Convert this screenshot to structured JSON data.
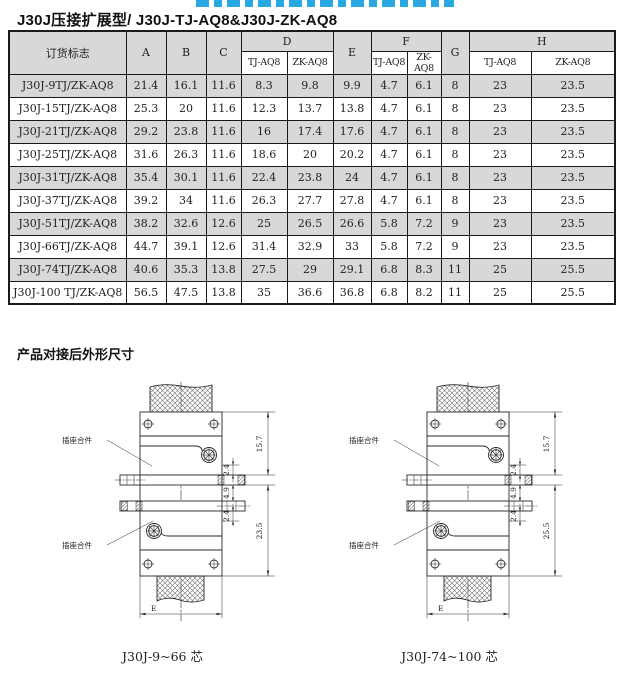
{
  "banner": {
    "note": "clipped blue heading, only glyph bottoms visible"
  },
  "title": "J30J压接扩展型/ J30J-TJ-AQ8&J30J-ZK-AQ8",
  "colors": {
    "banner_blue": "#29a9e2",
    "row_shade": "#d8d8d8",
    "line": "#2a2a2a"
  },
  "table": {
    "header": {
      "order_mark": "订货标志",
      "a": "A",
      "b": "B",
      "c": "C",
      "d": "D",
      "e": "E",
      "f": "F",
      "g": "G",
      "h": "H",
      "tj": "TJ-AQ8",
      "zk": "ZK-AQ8"
    },
    "rows": [
      {
        "label": "J30J-9TJ/ZK-AQ8",
        "values": [
          "21.4",
          "16.1",
          "11.6",
          "8.3",
          "9.8",
          "9.9",
          "4.7",
          "6.1",
          "8",
          "23",
          "23.5"
        ]
      },
      {
        "label": "J30J-15TJ/ZK-AQ8",
        "values": [
          "25.3",
          "20",
          "11.6",
          "12.3",
          "13.7",
          "13.8",
          "4.7",
          "6.1",
          "8",
          "23",
          "23.5"
        ]
      },
      {
        "label": "J30J-21TJ/ZK-AQ8",
        "values": [
          "29.2",
          "23.8",
          "11.6",
          "16",
          "17.4",
          "17.6",
          "4.7",
          "6.1",
          "8",
          "23",
          "23.5"
        ]
      },
      {
        "label": "J30J-25TJ/ZK-AQ8",
        "values": [
          "31.6",
          "26.3",
          "11.6",
          "18.6",
          "20",
          "20.2",
          "4.7",
          "6.1",
          "8",
          "23",
          "23.5"
        ]
      },
      {
        "label": "J30J-31TJ/ZK-AQ8",
        "values": [
          "35.4",
          "30.1",
          "11.6",
          "22.4",
          "23.8",
          "24",
          "4.7",
          "6.1",
          "8",
          "23",
          "23.5"
        ]
      },
      {
        "label": "J30J-37TJ/ZK-AQ8",
        "values": [
          "39.2",
          "34",
          "11.6",
          "26.3",
          "27.7",
          "27.8",
          "4.7",
          "6.1",
          "8",
          "23",
          "23.5"
        ]
      },
      {
        "label": "J30J-51TJ/ZK-AQ8",
        "values": [
          "38.2",
          "32.6",
          "12.6",
          "25",
          "26.5",
          "26.6",
          "5.8",
          "7.2",
          "9",
          "23",
          "23.5"
        ]
      },
      {
        "label": "J30J-66TJ/ZK-AQ8",
        "values": [
          "44.7",
          "39.1",
          "12.6",
          "31.4",
          "32.9",
          "33",
          "5.8",
          "7.2",
          "9",
          "23",
          "23.5"
        ]
      },
      {
        "label": "J30J-74TJ/ZK-AQ8",
        "values": [
          "40.6",
          "35.3",
          "13.8",
          "27.5",
          "29",
          "29.1",
          "6.8",
          "8.3",
          "11",
          "25",
          "25.5"
        ]
      },
      {
        "label": "J30J-100 TJ/ZK-AQ8",
        "values": [
          "56.5",
          "47.5",
          "13.8",
          "35",
          "36.6",
          "36.8",
          "6.8",
          "8.2",
          "11",
          "25",
          "25.5"
        ]
      }
    ]
  },
  "section": {
    "title": "产品对接后外形尺寸"
  },
  "drawing": {
    "part_label_top": "插座合件",
    "part_label_bottom": "插座合件",
    "dim_157": "15.7",
    "dim_24": "2.4",
    "dim_49": "4.9",
    "dim_e": "E",
    "left": {
      "dim_total": "23.5",
      "caption": "J30J-9~66 芯"
    },
    "right": {
      "dim_total": "25.5",
      "caption": "J30J-74~100 芯"
    }
  }
}
